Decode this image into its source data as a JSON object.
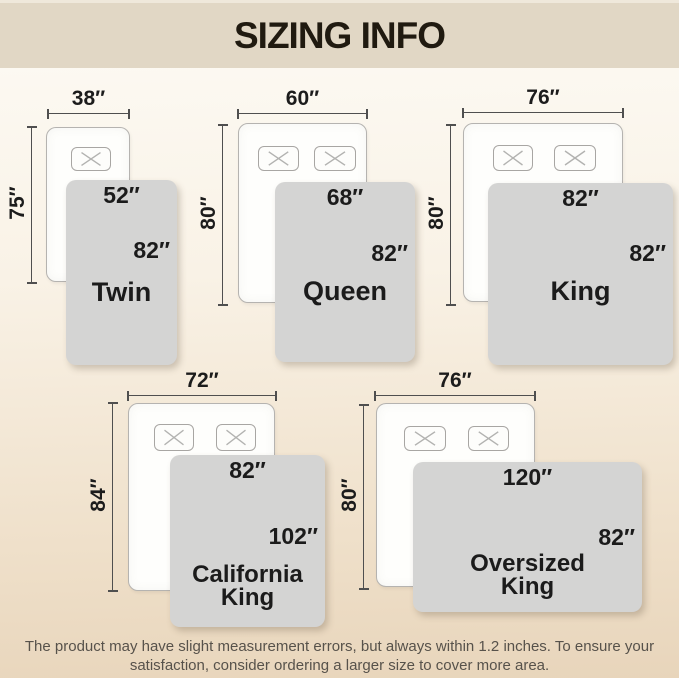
{
  "header": {
    "title": "SIZING INFO"
  },
  "sizes": [
    {
      "name": "Twin",
      "bed_width": "38″",
      "bed_length": "75″",
      "blanket_width": "52″",
      "blanket_length": "82″",
      "pillow_count": 1
    },
    {
      "name": "Queen",
      "bed_width": "60″",
      "bed_length": "80″",
      "blanket_width": "68″",
      "blanket_length": "82″",
      "pillow_count": 2
    },
    {
      "name": "King",
      "bed_width": "76″",
      "bed_length": "80″",
      "blanket_width": "82″",
      "blanket_length": "82″",
      "pillow_count": 2
    },
    {
      "name": "California King",
      "bed_width": "72″",
      "bed_length": "84″",
      "blanket_width": "82″",
      "blanket_length": "102″",
      "pillow_count": 2
    },
    {
      "name": "Oversized King",
      "bed_width": "76″",
      "bed_length": "80″",
      "blanket_width": "120″",
      "blanket_length": "82″",
      "pillow_count": 2
    }
  ],
  "footer": {
    "disclaimer": "The product may have slight measurement errors, but always within 1.2 inches. To ensure your satisfaction, consider ordering a larger size to cover more area."
  },
  "colors": {
    "header_band": "#e1d7c5",
    "background_top": "#fcf9f2",
    "background_bottom": "#e8d5bb",
    "blanket_gray": "#d4d4d3",
    "bed_outline": "#b5b3b0",
    "dimension_line": "#4f4f4f",
    "label_text": "#1c1c1c",
    "footer_text": "#57524b"
  }
}
